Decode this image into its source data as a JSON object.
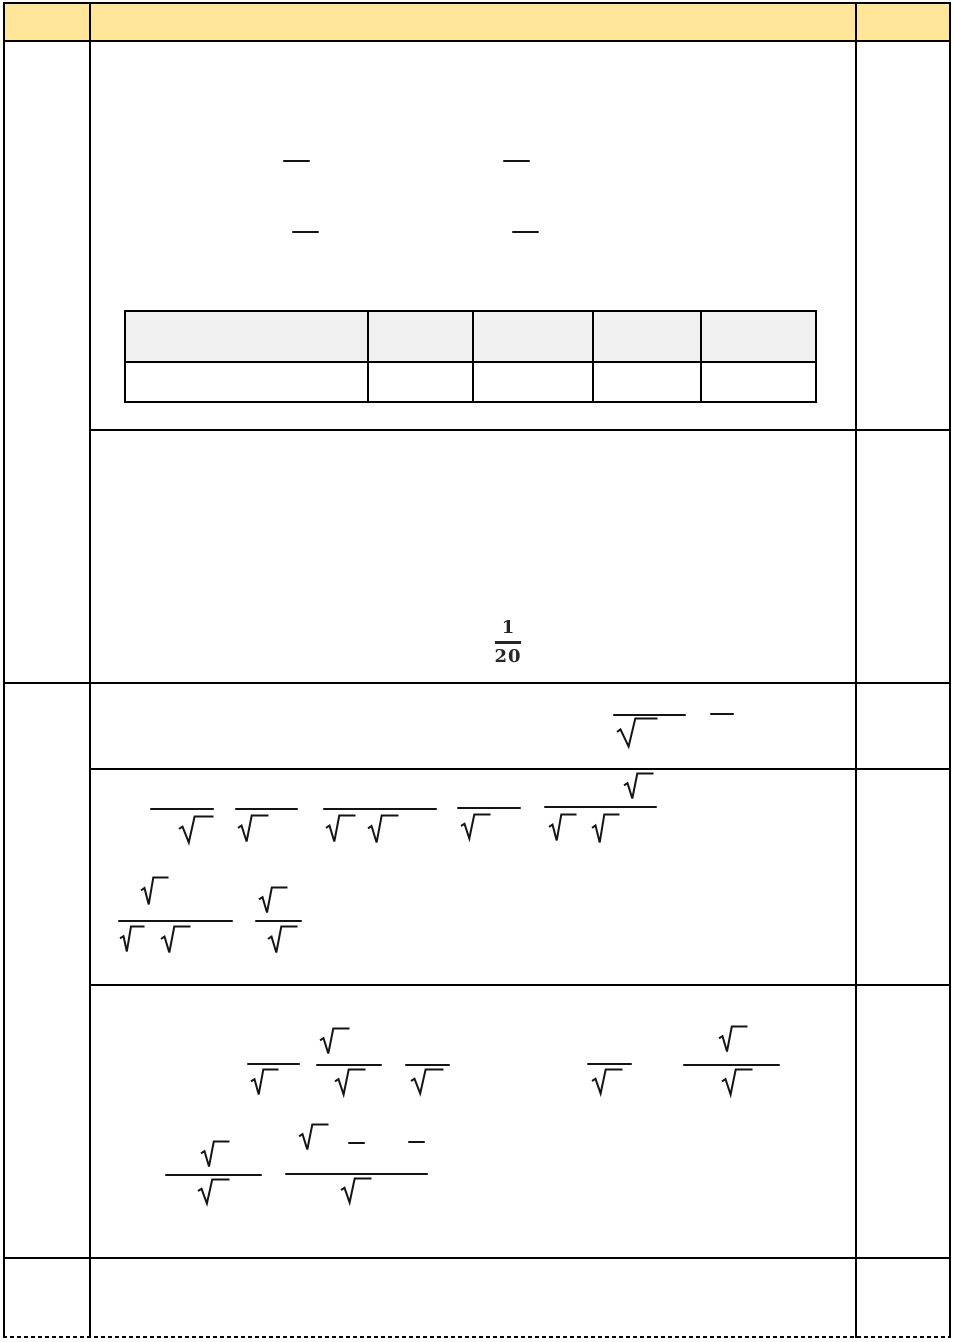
{
  "page": {
    "kind": "math-worksheet-page",
    "width": 954,
    "height": 1342
  },
  "colors": {
    "page_bg": "#FFFFFF",
    "header_band_fill": "#FFE699",
    "answer_table_header_fill": "#F0F0F0",
    "grid_line": "#000000",
    "math_ink": "#141414",
    "fraction_text": "#262626"
  },
  "header_row": {
    "note": "yellow band split into three cells, no visible text",
    "col1_text": "",
    "col2_text": "",
    "col3_text": ""
  },
  "question1": {
    "visible_fraction": {
      "numerator": "1",
      "denominator": "20"
    },
    "answer_table": {
      "columns": [
        "",
        "",
        "",
        "",
        ""
      ],
      "rows": [
        [
          "",
          "",
          "",
          "",
          ""
        ]
      ],
      "header_shaded": true
    }
  },
  "marks": [
    {
      "t": "bar",
      "x": 283,
      "y": 160,
      "w": 27
    },
    {
      "t": "bar",
      "x": 503,
      "y": 160,
      "w": 27
    },
    {
      "t": "bar",
      "x": 292,
      "y": 231,
      "w": 27
    },
    {
      "t": "bar",
      "x": 512,
      "y": 231,
      "w": 27
    },
    {
      "t": "bar",
      "x": 613,
      "y": 714,
      "w": 73
    },
    {
      "t": "rad",
      "x": 616,
      "y": 717,
      "w": 42,
      "h": 31
    },
    {
      "t": "bar",
      "x": 710,
      "y": 713,
      "w": 24
    },
    {
      "t": "bar",
      "x": 150,
      "y": 808,
      "w": 64
    },
    {
      "t": "rad",
      "x": 178,
      "y": 815,
      "w": 36,
      "h": 29
    },
    {
      "t": "bar",
      "x": 235,
      "y": 808,
      "w": 63
    },
    {
      "t": "rad",
      "x": 237,
      "y": 814,
      "w": 32,
      "h": 29
    },
    {
      "t": "bar",
      "x": 323,
      "y": 808,
      "w": 114
    },
    {
      "t": "rad",
      "x": 325,
      "y": 814,
      "w": 31,
      "h": 29
    },
    {
      "t": "rad",
      "x": 367,
      "y": 814,
      "w": 32,
      "h": 30
    },
    {
      "t": "bar",
      "x": 457,
      "y": 807,
      "w": 64
    },
    {
      "t": "rad",
      "x": 460,
      "y": 813,
      "w": 31,
      "h": 27
    },
    {
      "t": "rad",
      "x": 623,
      "y": 772,
      "w": 31,
      "h": 28
    },
    {
      "t": "bar",
      "x": 544,
      "y": 806,
      "w": 113
    },
    {
      "t": "rad",
      "x": 548,
      "y": 813,
      "w": 29,
      "h": 29
    },
    {
      "t": "rad",
      "x": 591,
      "y": 813,
      "w": 29,
      "h": 31
    },
    {
      "t": "rad",
      "x": 140,
      "y": 876,
      "w": 29,
      "h": 30
    },
    {
      "t": "bar",
      "x": 118,
      "y": 920,
      "w": 115
    },
    {
      "t": "rad",
      "x": 119,
      "y": 925,
      "w": 26,
      "h": 28
    },
    {
      "t": "rad",
      "x": 160,
      "y": 925,
      "w": 31,
      "h": 29
    },
    {
      "t": "rad",
      "x": 258,
      "y": 886,
      "w": 30,
      "h": 28
    },
    {
      "t": "bar",
      "x": 255,
      "y": 920,
      "w": 47
    },
    {
      "t": "rad",
      "x": 267,
      "y": 925,
      "w": 31,
      "h": 29
    },
    {
      "t": "bar",
      "x": 247,
      "y": 1063,
      "w": 53
    },
    {
      "t": "rad",
      "x": 250,
      "y": 1068,
      "w": 29,
      "h": 28
    },
    {
      "t": "rad",
      "x": 319,
      "y": 1027,
      "w": 31,
      "h": 28
    },
    {
      "t": "bar",
      "x": 316,
      "y": 1064,
      "w": 66
    },
    {
      "t": "rad",
      "x": 334,
      "y": 1068,
      "w": 32,
      "h": 28
    },
    {
      "t": "bar",
      "x": 405,
      "y": 1064,
      "w": 45
    },
    {
      "t": "rad",
      "x": 410,
      "y": 1068,
      "w": 34,
      "h": 27
    },
    {
      "t": "bar",
      "x": 587,
      "y": 1063,
      "w": 45
    },
    {
      "t": "rad",
      "x": 591,
      "y": 1068,
      "w": 32,
      "h": 27
    },
    {
      "t": "rad",
      "x": 718,
      "y": 1025,
      "w": 30,
      "h": 28
    },
    {
      "t": "bar",
      "x": 683,
      "y": 1064,
      "w": 97
    },
    {
      "t": "rad",
      "x": 721,
      "y": 1068,
      "w": 32,
      "h": 28
    },
    {
      "t": "rad",
      "x": 200,
      "y": 1140,
      "w": 30,
      "h": 28
    },
    {
      "t": "bar",
      "x": 165,
      "y": 1174,
      "w": 97
    },
    {
      "t": "rad",
      "x": 197,
      "y": 1178,
      "w": 33,
      "h": 27
    },
    {
      "t": "rad",
      "x": 298,
      "y": 1123,
      "w": 31,
      "h": 28
    },
    {
      "t": "dash",
      "x": 348,
      "y": 1142,
      "w": 17
    },
    {
      "t": "dash",
      "x": 408,
      "y": 1141,
      "w": 17
    },
    {
      "t": "bar",
      "x": 285,
      "y": 1173,
      "w": 143
    },
    {
      "t": "rad",
      "x": 340,
      "y": 1177,
      "w": 32,
      "h": 27
    }
  ]
}
